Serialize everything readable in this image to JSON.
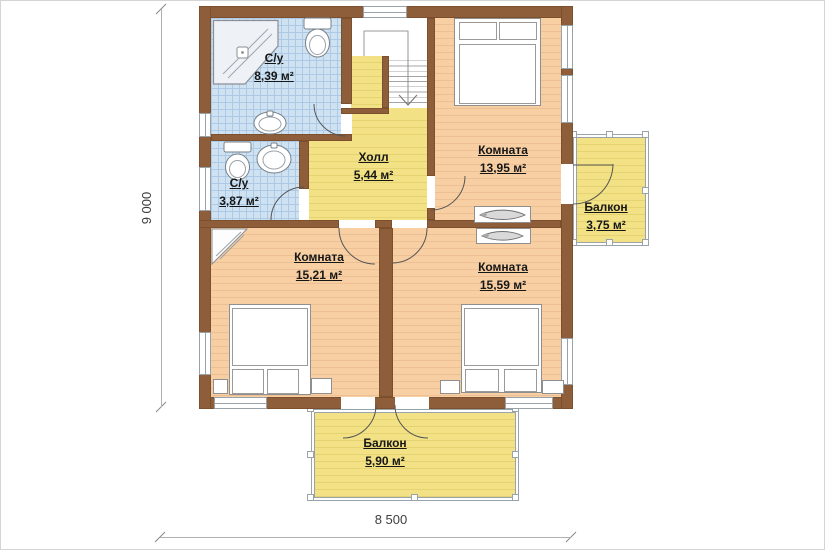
{
  "colors": {
    "wall": "#8d5e39",
    "floor_peach": "#f7cfa3",
    "floor_peach_line": "#edbf94",
    "floor_yellow": "#f2e285",
    "floor_yellow_line": "#e5d372",
    "tile_blue": "#cfe2f2",
    "tile_blue_line": "#adc9e6"
  },
  "rooms": {
    "bath_large": {
      "name": "С/у",
      "area": "8,39 м²"
    },
    "bath_small": {
      "name": "С/у",
      "area": "3,87 м²"
    },
    "hall": {
      "name": "Холл",
      "area": "5,44 м²"
    },
    "bedroom_top": {
      "name": "Комната",
      "area": "13,95 м²"
    },
    "balcony_right": {
      "name": "Балкон",
      "area": "3,75 м²"
    },
    "bedroom_left": {
      "name": "Комната",
      "area": "15,21 м²"
    },
    "bedroom_right": {
      "name": "Комната",
      "area": "15,59 м²"
    },
    "balcony_bottom": {
      "name": "Балкон",
      "area": "5,90 м²"
    }
  },
  "dimensions": {
    "height_label": "9 000",
    "width_label": "8 500"
  }
}
